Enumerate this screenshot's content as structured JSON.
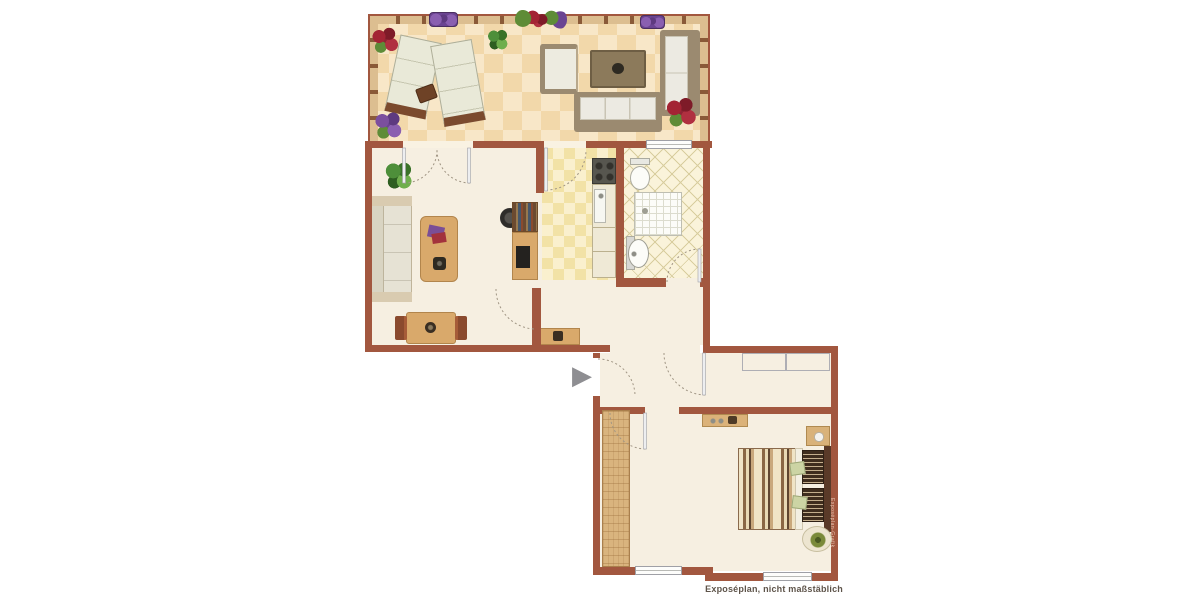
{
  "plan": {
    "caption": "Exposéplan, nicht maßstäblich",
    "watermark": "Exposéplan-Grafik",
    "entrance_symbol": "▶"
  },
  "colors": {
    "wall": "#A2573F",
    "floor-cream": "#F6EFE1",
    "terrace-tile-a": "#F8E7C8",
    "terrace-tile-b": "#F2D8AA",
    "kitchen-tile-a": "#FAF0CE",
    "kitchen-tile-b": "#F2E2A6",
    "bath-floor": "#FAF3DA",
    "bath-line": "#D8CD9E",
    "rail-wood": "#DCBE90",
    "rail-post": "#8A5A38",
    "wood": "#D9A96B",
    "wood-dark": "#8A4A2E",
    "sofa-frame": "#9B8A70",
    "cushion": "#EDEBE0",
    "gray-furniture": "#DADADE",
    "arrow-gray": "#8E8E92",
    "caption-text": "#5E544A"
  },
  "rooms": [
    {
      "name": "terrace",
      "furniture": [
        "sun-lounger",
        "sun-lounger",
        "side-table",
        "armchair",
        "coffee-table",
        "sofa",
        "sofa",
        "flowers",
        "plants"
      ]
    },
    {
      "name": "living-room",
      "furniture": [
        "sofa",
        "coffee-table",
        "desk",
        "office-chair",
        "dining-table",
        "chairs",
        "console",
        "plant"
      ]
    },
    {
      "name": "kitchen",
      "furniture": [
        "stove",
        "sink",
        "counter"
      ]
    },
    {
      "name": "bathroom",
      "furniture": [
        "toilet",
        "shower",
        "washbasin"
      ]
    },
    {
      "name": "hall",
      "furniture": [
        "sideboard"
      ]
    },
    {
      "name": "bedroom",
      "furniture": [
        "wardrobe",
        "shelf",
        "double-bed",
        "nightstand",
        "plant-stool"
      ]
    }
  ]
}
